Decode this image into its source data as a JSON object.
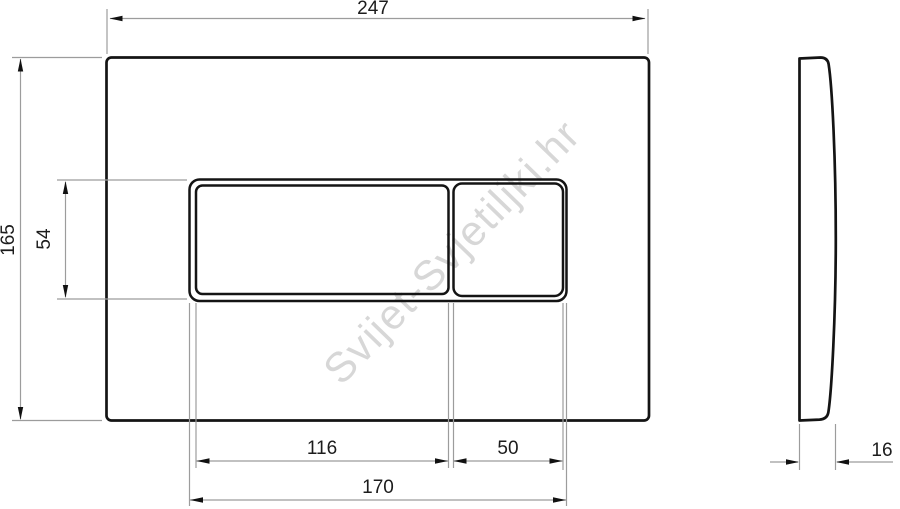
{
  "watermark": {
    "text": "Svijet-Svjetiljki.hr",
    "color": "#d7d7d7"
  },
  "colors": {
    "background": "#ffffff",
    "outline": "#141414",
    "dimension_line": "#9c9c9c",
    "dimension_text": "#1c1c1c"
  },
  "drawing": {
    "type": "technical-dimension-drawing",
    "subject": "flush-plate",
    "front_view": {
      "overall_width": "247",
      "overall_height": "165",
      "button_area_height": "54",
      "large_button_width": "116",
      "small_button_width": "50",
      "button_area_width": "170"
    },
    "side_view": {
      "thickness": "16"
    }
  }
}
